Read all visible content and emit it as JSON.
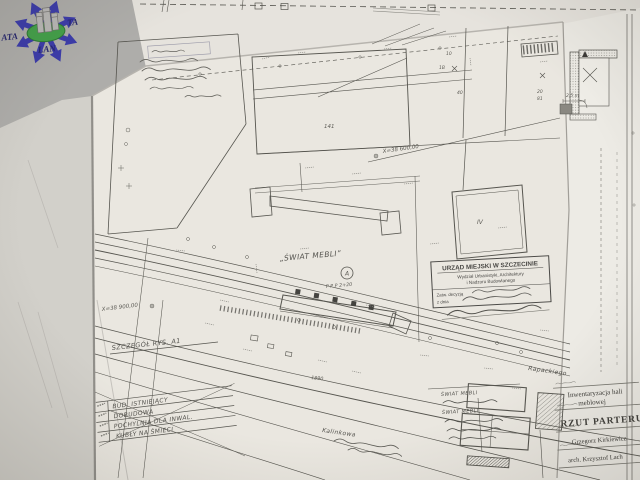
{
  "logo": {
    "text_left": "ATA",
    "text_right": "TA",
    "text_bottom": "LAN"
  },
  "colors": {
    "paper": "#eae7e0",
    "ink": "#56554f",
    "logo_blue": "#3c3caa",
    "logo_green": "#44a04a",
    "logo_navy": "#27276e"
  },
  "plan": {
    "building_label": "„ŚWIAT MEBLI”",
    "marker_a": "A",
    "note_ppp": "P P P  2+20",
    "coord_top": "X=38 600,00",
    "coord_left": "X=38 900,00",
    "detail_ref": "SZCZEGÓŁ RYS. A1",
    "street_1": "Rapackiego",
    "street_2": "Kalinkowa",
    "dim_a": "1890",
    "parcels": {
      "p141": "141",
      "p10": "10",
      "p1b": "1B",
      "p40": "40",
      "p20": "20",
      "p81": "81",
      "p4": "IV"
    }
  },
  "legend": {
    "rows": [
      "BUD. ISTNIEJĄCY",
      "DOBUDOWA",
      "POCHYLNIA DLA INWAL.",
      "KUBŁY NA ŚMIECI"
    ]
  },
  "stamp": {
    "org": "URZĄD MIEJSKI W SZCZECINIE",
    "dept1": "Wydział Urbanistyki, Architektury",
    "dept2": "i Nadzoru Budowlanego",
    "f1": "Zatw. decyzją",
    "f2": "z dnia"
  },
  "notes": {
    "n1": "ŚWIAT MEBLI",
    "n2": "ŚWIAT MEBLI"
  },
  "detail_room": {
    "dim": "2,5 m"
  },
  "title_block": {
    "project1": "Inwentaryzacja hali",
    "project2": "meblowej",
    "drawing": "RZUT PARTERU",
    "author1": "Grzegorz Kirkiewicz",
    "author2": "arch. Krzysztof Lach"
  }
}
